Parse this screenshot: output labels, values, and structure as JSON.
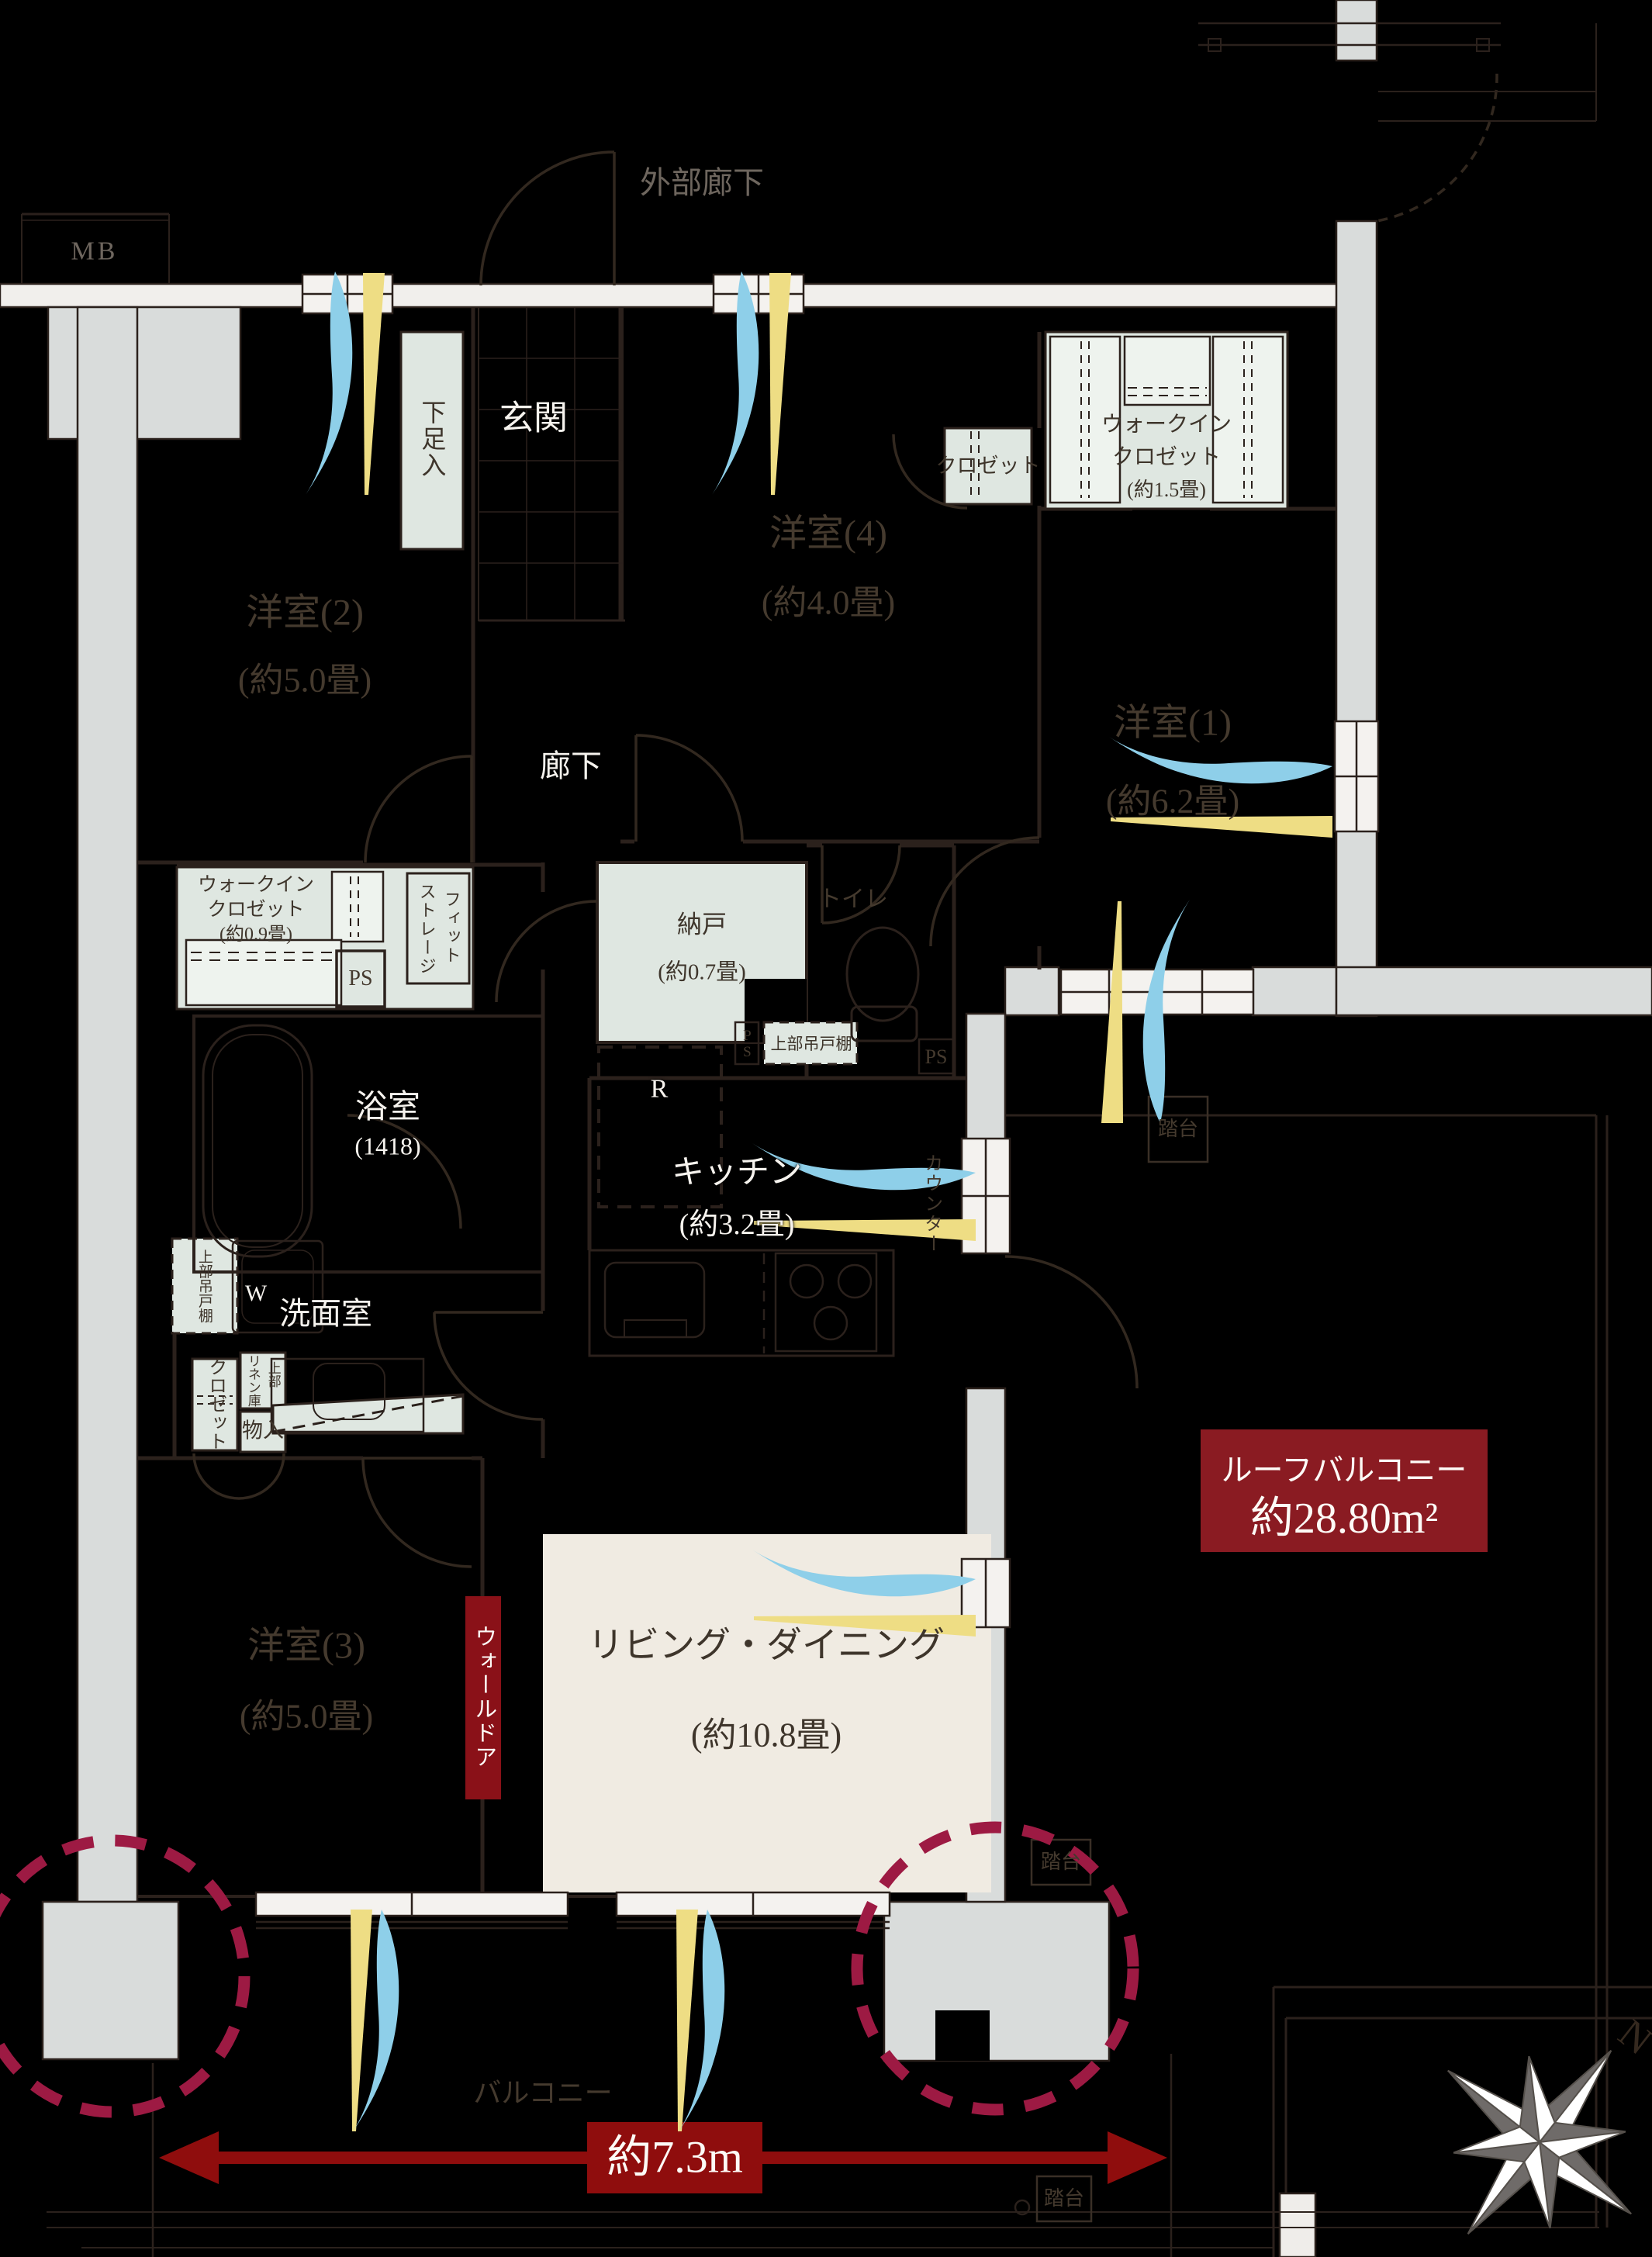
{
  "labels": {
    "exterior_corridor": "外部廊下",
    "mb": "MB",
    "entrance": "玄関",
    "shoe_cabinet": "下足入",
    "hallway": "廊下",
    "room2_name": "洋室(2)",
    "room2_size": "(約5.0畳)",
    "room4_name": "洋室(4)",
    "room4_size": "(約4.0畳)",
    "room1_name": "洋室(1)",
    "room1_size": "(約6.2畳)",
    "room3_name": "洋室(3)",
    "room3_size": "(約5.0畳)",
    "closet": "クロゼット",
    "wic15_l1": "ウォークイン",
    "wic15_l2": "クロゼット",
    "wic15_l3": "(約1.5畳)",
    "wic09_l1": "ウォークイン",
    "wic09_l2": "クロゼット",
    "wic09_l3": "(約0.9畳)",
    "fit_storage_l1": "フィット",
    "fit_storage_l2": "ストレージ",
    "ps": "PS",
    "ps_small": "PS",
    "ps2": "PS",
    "storeroom_name": "納戸",
    "storeroom_size": "(約0.7畳)",
    "toilet": "トイレ",
    "upper_cabinet_kitchen": "上部吊戸棚",
    "upper_cabinet_wash": "上部吊戸棚",
    "bath_name": "浴室",
    "bath_size": "(1418)",
    "kitchen_name": "キッチン",
    "kitchen_size": "(約3.2畳)",
    "counter": "カウンター",
    "refrigerator": "R",
    "washroom": "洗面室",
    "washer": "W",
    "linen": "リネン庫",
    "linen_upper": "上部",
    "storage_small": "物入",
    "wall_door": "ウォールドア",
    "living_name": "リビング・ダイニング",
    "living_size": "(約10.8畳)",
    "roof_balcony_name": "ルーフバルコニー",
    "roof_balcony_area": "約28.80m²",
    "balcony": "バルコニー",
    "step": "踏台",
    "width_dimension": "約7.3m",
    "compass_north": "N"
  },
  "colors": {
    "background": "#000000",
    "wall_gray": "#d9dcdb",
    "wall_white": "#f1efec",
    "line_dark": "#2b211c",
    "fixture_green": "#dfe7e1",
    "living_cream": "#f0ebe2",
    "annotation_red": "#8a1b22",
    "arrow_red": "#8f0d0d",
    "pillar_circle_crimson": "#9d1a43",
    "wind_blue": "#8ecfe9",
    "wind_yellow": "#eedd84"
  }
}
